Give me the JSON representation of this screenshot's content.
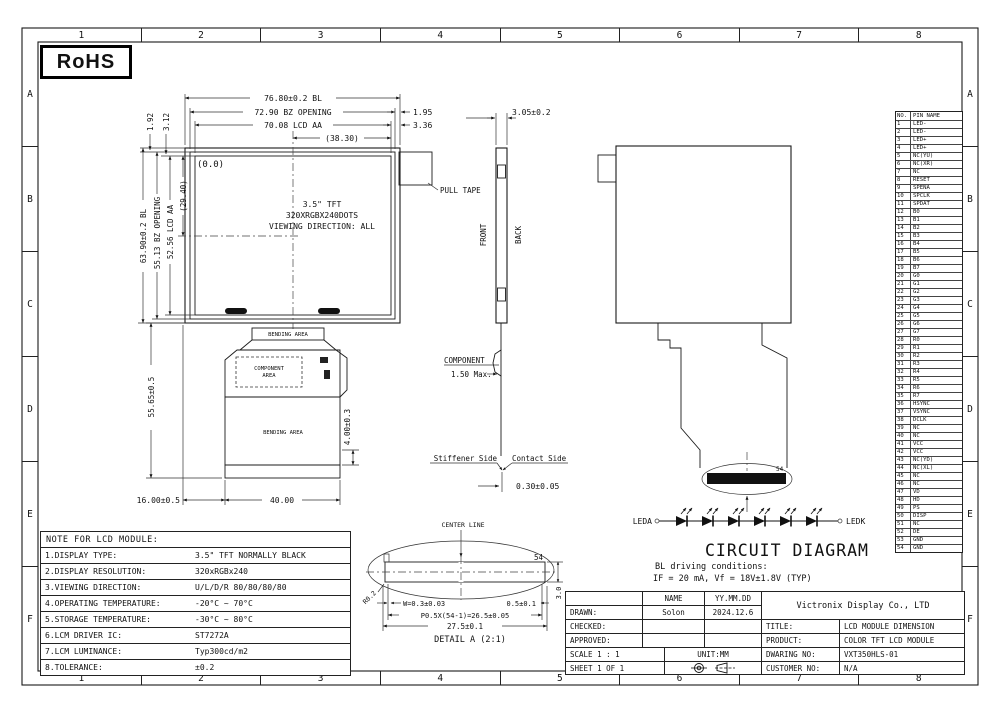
{
  "rohs": {
    "label": "RoHS"
  },
  "zones": {
    "cols": [
      "1",
      "2",
      "3",
      "4",
      "5",
      "6",
      "7",
      "8"
    ],
    "rows": [
      "A",
      "B",
      "C",
      "D",
      "E",
      "F"
    ]
  },
  "drawing": {
    "front": {
      "dim_bl_w": "76.80±0.2 BL",
      "dim_bz_w": "72.90 BZ OPENING",
      "dim_aa_w": "70.08 LCD AA",
      "dim_half_w": "(38.30)",
      "dim_r1": "1.95",
      "dim_r2": "3.36",
      "dim_l1": "1.92",
      "dim_l2": "3.12",
      "dim_bl_h": "63.90±0.2 BL",
      "dim_bz_h": "55.13 BZ OPENING",
      "dim_aa_h": "52.56 LCD AA",
      "dim_half_h": "(29.40)",
      "origin": "(0.0)",
      "panel_line1": "3.5\" TFT",
      "panel_line2": "320XRGBX240DOTS",
      "panel_line3": "VIEWING DIRECTION: ALL",
      "pull_tape": "PULL TAPE"
    },
    "fpc": {
      "bending_top": "BENDING AREA",
      "component_area1": "COMPONENT",
      "component_area2": "AREA",
      "bending_big": "BENDING AREA",
      "dim_h": "55.65±0.5",
      "dim_left": "16.00±0.5",
      "dim_w": "40.00",
      "dim_bend": "4.00±0.3"
    },
    "side": {
      "dim_t": "3.05±0.2",
      "front": "FRONT",
      "back": "BACK",
      "component": "COMPONENT",
      "component_max": "1.50 Max.",
      "stiffener": "Stiffener Side",
      "contact": "Contact Side",
      "dim_fpc": "0.30±0.05"
    },
    "back": {
      "pin54": "54"
    },
    "circuit": {
      "leda": "LEDA",
      "ledk": "LEDK",
      "title": "CIRCUIT DIAGRAM",
      "cond1": "BL driving conditions:",
      "cond2": "IF = 20 mA, Vf = 18V±1.8V (TYP)"
    },
    "detail_a": {
      "center_line": "CENTER LINE",
      "pin54": "54",
      "radius": "R0.2",
      "w": "W=0.3±0.03",
      "end": "0.5±0.1",
      "pitch": "P0.5X(54-1)=26.5±0.05",
      "total": "27.5±0.1",
      "h": "3.0",
      "caption": "DETAIL A (2:1)"
    }
  },
  "pin_table": {
    "header_no": "NO.",
    "header_name": "PIN NAME",
    "rows": [
      {
        "no": "1",
        "name": "LED-"
      },
      {
        "no": "2",
        "name": "LED-"
      },
      {
        "no": "3",
        "name": "LED+"
      },
      {
        "no": "4",
        "name": "LED+"
      },
      {
        "no": "5",
        "name": "NC(YU)"
      },
      {
        "no": "6",
        "name": "NC(XR)"
      },
      {
        "no": "7",
        "name": "NC"
      },
      {
        "no": "8",
        "name": "RESET"
      },
      {
        "no": "9",
        "name": "SPENA"
      },
      {
        "no": "10",
        "name": "SPCLK"
      },
      {
        "no": "11",
        "name": "SPDAT"
      },
      {
        "no": "12",
        "name": "B0"
      },
      {
        "no": "13",
        "name": "B1"
      },
      {
        "no": "14",
        "name": "B2"
      },
      {
        "no": "15",
        "name": "B3"
      },
      {
        "no": "16",
        "name": "B4"
      },
      {
        "no": "17",
        "name": "B5"
      },
      {
        "no": "18",
        "name": "B6"
      },
      {
        "no": "19",
        "name": "B7"
      },
      {
        "no": "20",
        "name": "G0"
      },
      {
        "no": "21",
        "name": "G1"
      },
      {
        "no": "22",
        "name": "G2"
      },
      {
        "no": "23",
        "name": "G3"
      },
      {
        "no": "24",
        "name": "G4"
      },
      {
        "no": "25",
        "name": "G5"
      },
      {
        "no": "26",
        "name": "G6"
      },
      {
        "no": "27",
        "name": "G7"
      },
      {
        "no": "28",
        "name": "R0"
      },
      {
        "no": "29",
        "name": "R1"
      },
      {
        "no": "30",
        "name": "R2"
      },
      {
        "no": "31",
        "name": "R3"
      },
      {
        "no": "32",
        "name": "R4"
      },
      {
        "no": "33",
        "name": "R5"
      },
      {
        "no": "34",
        "name": "R6"
      },
      {
        "no": "35",
        "name": "R7"
      },
      {
        "no": "36",
        "name": "HSYNC"
      },
      {
        "no": "37",
        "name": "VSYNC"
      },
      {
        "no": "38",
        "name": "DCLK"
      },
      {
        "no": "39",
        "name": "NC"
      },
      {
        "no": "40",
        "name": "NC"
      },
      {
        "no": "41",
        "name": "VCC"
      },
      {
        "no": "42",
        "name": "VCC"
      },
      {
        "no": "43",
        "name": "NC(YD)"
      },
      {
        "no": "44",
        "name": "NC(XL)"
      },
      {
        "no": "45",
        "name": "NC"
      },
      {
        "no": "46",
        "name": "NC"
      },
      {
        "no": "47",
        "name": "VD"
      },
      {
        "no": "48",
        "name": "HD"
      },
      {
        "no": "49",
        "name": "PS"
      },
      {
        "no": "50",
        "name": "DISP"
      },
      {
        "no": "51",
        "name": "NC"
      },
      {
        "no": "52",
        "name": "DE"
      },
      {
        "no": "53",
        "name": "GND"
      },
      {
        "no": "54",
        "name": "GND"
      }
    ]
  },
  "notes": {
    "title": "NOTE FOR LCD MODULE:",
    "rows": [
      {
        "label": "1.DISPLAY TYPE:",
        "value": "3.5\" TFT NORMALLY BLACK"
      },
      {
        "label": "2.DISPLAY RESOLUTION:",
        "value": "320xRGBx240"
      },
      {
        "label": "3.VIEWING DIRECTION:",
        "value": "U/L/D/R 80/80/80/80"
      },
      {
        "label": "4.OPERATING TEMPERATURE:",
        "value": "-20°C ~ 70°C"
      },
      {
        "label": "5.STORAGE TEMPERATURE:",
        "value": "-30°C ~ 80°C"
      },
      {
        "label": "6.LCM DRIVER IC:",
        "value": "ST7272A"
      },
      {
        "label": "7.LCM LUMINANCE:",
        "value": "Typ300cd/m2"
      },
      {
        "label": "8.TOLERANCE:",
        "value": "±0.2"
      }
    ]
  },
  "title_block": {
    "name_h": "NAME",
    "date_h": "YY.MM.DD",
    "drawn_l": "DRAWN:",
    "drawn_name": "Solon",
    "drawn_date": "2024.12.6",
    "checked_l": "CHECKED:",
    "approved_l": "APPROVED:",
    "company": "Victronix Display Co., LTD",
    "title_l": "TITLE:",
    "title_v": "LCD MODULE DIMENSION",
    "product_l": "PRODUCT:",
    "product_v": "COLOR TFT LCD MODULE",
    "scale": "SCALE 1 : 1",
    "unit": "UNIT:MM",
    "drawing_l": "DWARING NO:",
    "drawing_v": "VXT350HLS-01",
    "sheet": "SHEET 1 OF 1",
    "customer_l": "CUSTOMER NO:",
    "customer_v": "N/A"
  }
}
